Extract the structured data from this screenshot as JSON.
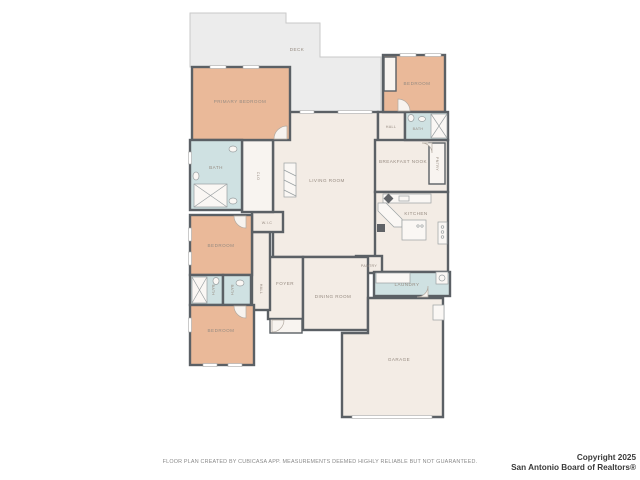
{
  "title": "Residential floor plan",
  "colors": {
    "wall": "#5b6065",
    "bedroom_fill": "#eab999",
    "bath_fill": "#cfe1e2",
    "floor_fill": "#f3ece5",
    "deck_fill": "#ececec",
    "label_text": "#968b81",
    "disclaimer_text": "#8a8a8a",
    "copyright_text": "#3a3a3a"
  },
  "floor_plan": {
    "rooms": [
      {
        "id": "deck",
        "label": "DECK"
      },
      {
        "id": "primary-bedroom",
        "label": "PRIMARY BEDROOM"
      },
      {
        "id": "primary-bath",
        "label": "BATH"
      },
      {
        "id": "closet",
        "label": "CLO"
      },
      {
        "id": "living-room",
        "label": "LIVING ROOM"
      },
      {
        "id": "bedroom-top-right",
        "label": "BEDROOM"
      },
      {
        "id": "hall-upper",
        "label": "HALL"
      },
      {
        "id": "hall-bath",
        "label": "BATH"
      },
      {
        "id": "breakfast-nook",
        "label": "BREAKFAST NOOK"
      },
      {
        "id": "pantry-closet",
        "label": "PNTRY"
      },
      {
        "id": "kitchen",
        "label": "KITCHEN"
      },
      {
        "id": "pantry",
        "label": "PANTRY"
      },
      {
        "id": "laundry",
        "label": "LAUNDRY"
      },
      {
        "id": "foyer",
        "label": "FOYER"
      },
      {
        "id": "dining-room",
        "label": "DINING ROOM"
      },
      {
        "id": "hall-lower",
        "label": "HALL"
      },
      {
        "id": "wic",
        "label": "W.I.C"
      },
      {
        "id": "bedroom-middle",
        "label": "BEDROOM"
      },
      {
        "id": "bath-left",
        "label": "BATH"
      },
      {
        "id": "bath-right",
        "label": "BATH"
      },
      {
        "id": "bedroom-bottom",
        "label": "BEDROOM"
      },
      {
        "id": "garage",
        "label": "GARAGE"
      }
    ]
  },
  "footer": {
    "disclaimer": "FLOOR PLAN CREATED BY CUBICASA APP. MEASUREMENTS DEEMED HIGHLY RELIABLE BUT NOT GUARANTEED.",
    "copyright_line1": "Copyright 2025",
    "copyright_line2": "San Antonio Board of Realtors®"
  }
}
